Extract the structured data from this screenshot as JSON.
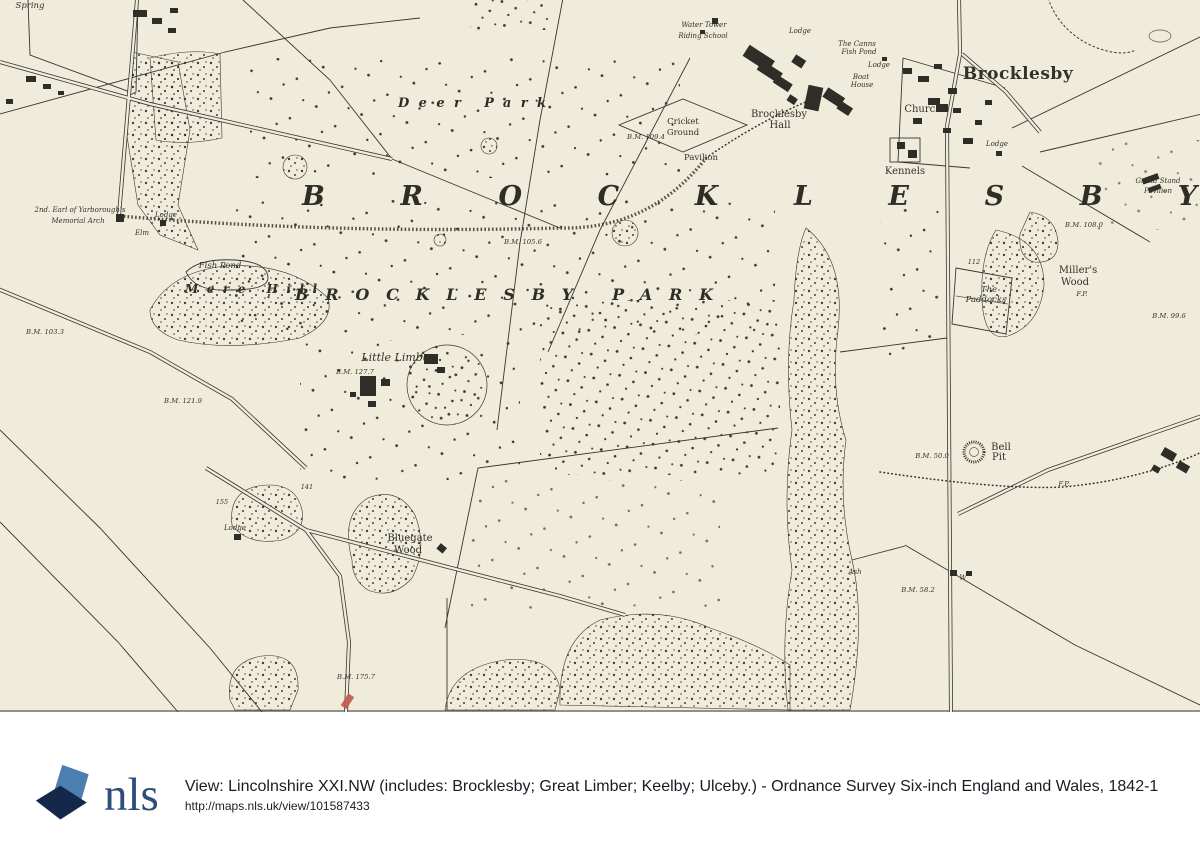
{
  "map": {
    "background_color": "#f0ecdb",
    "ink_color": "#38362e",
    "red_mark_color": "#c4574b",
    "titles": {
      "district": "BROCKLESBY",
      "park": "BROCKLESBY PARK",
      "deer_park": "Deer Park",
      "mere_hill": "Mere Hill"
    },
    "labels": [
      {
        "text": "Spring",
        "x": 30,
        "y": 8,
        "cls": "s"
      },
      {
        "text": "2nd. Earl of Yarborough's",
        "x": 80,
        "y": 212,
        "cls": "xs"
      },
      {
        "text": "Memorial Arch",
        "x": 78,
        "y": 223,
        "cls": "xs"
      },
      {
        "text": "Lodge",
        "x": 166,
        "y": 217,
        "cls": "xs"
      },
      {
        "text": "Elm",
        "x": 142,
        "y": 235,
        "cls": "xs"
      },
      {
        "text": "Fish Pond",
        "x": 220,
        "y": 268,
        "cls": "s"
      },
      {
        "text": "Water Tower",
        "x": 704,
        "y": 27,
        "cls": "xs"
      },
      {
        "text": "Riding School",
        "x": 703,
        "y": 38,
        "cls": "xs"
      },
      {
        "text": "Lodge",
        "x": 800,
        "y": 33,
        "cls": "xs"
      },
      {
        "text": "The Canns",
        "x": 857,
        "y": 46,
        "cls": "xs"
      },
      {
        "text": "Fish Pond",
        "x": 859,
        "y": 54,
        "cls": "xs"
      },
      {
        "text": "Lodge",
        "x": 879,
        "y": 67,
        "cls": "xs"
      },
      {
        "text": "Boat",
        "x": 861,
        "y": 79,
        "cls": "xs"
      },
      {
        "text": "House",
        "x": 862,
        "y": 87,
        "cls": "xs"
      },
      {
        "text": "B.M. 109.4",
        "x": 646,
        "y": 139,
        "cls": "bm"
      },
      {
        "text": "Cricket",
        "x": 683,
        "y": 124,
        "cls": "rs"
      },
      {
        "text": "Ground",
        "x": 683,
        "y": 135,
        "cls": "rs"
      },
      {
        "text": "Pavilion",
        "x": 701,
        "y": 160,
        "cls": "rs"
      },
      {
        "text": "Brocklesby",
        "x": 779,
        "y": 117,
        "cls": "rm"
      },
      {
        "text": "Hall",
        "x": 780,
        "y": 128,
        "cls": "rm"
      },
      {
        "text": "Church",
        "x": 923,
        "y": 112,
        "cls": "rm"
      },
      {
        "text": "Kennels",
        "x": 905,
        "y": 174,
        "cls": "rm"
      },
      {
        "text": "Brocklesby",
        "x": 1018,
        "y": 79,
        "cls": "vil"
      },
      {
        "text": "Lodge",
        "x": 997,
        "y": 146,
        "cls": "xs"
      },
      {
        "text": "Grand Stand",
        "x": 1158,
        "y": 183,
        "cls": "xs"
      },
      {
        "text": "Pavilion",
        "x": 1158,
        "y": 193,
        "cls": "xs"
      },
      {
        "text": "B.M. 108.0",
        "x": 1084,
        "y": 227,
        "cls": "bm"
      },
      {
        "text": "112",
        "x": 974,
        "y": 264,
        "cls": "num"
      },
      {
        "text": "Miller's",
        "x": 1078,
        "y": 273,
        "cls": "rm"
      },
      {
        "text": "Wood",
        "x": 1075,
        "y": 285,
        "cls": "rm"
      },
      {
        "text": "The",
        "x": 989,
        "y": 292,
        "cls": "s"
      },
      {
        "text": "Paddocks",
        "x": 986,
        "y": 302,
        "cls": "s"
      },
      {
        "text": "F.P.",
        "x": 1082,
        "y": 296,
        "cls": "bm"
      },
      {
        "text": "B.M. 99.6",
        "x": 1169,
        "y": 318,
        "cls": "bm"
      },
      {
        "text": "B.M. 105.6",
        "x": 523,
        "y": 244,
        "cls": "bm"
      },
      {
        "text": "Little Limber",
        "x": 398,
        "y": 361,
        "cls": "m"
      },
      {
        "text": "B.M. 127.7",
        "x": 355,
        "y": 374,
        "cls": "bm"
      },
      {
        "text": "B.M. 103.3",
        "x": 45,
        "y": 334,
        "cls": "bm"
      },
      {
        "text": "B.M. 121.9",
        "x": 183,
        "y": 403,
        "cls": "bm"
      },
      {
        "text": "141",
        "x": 307,
        "y": 489,
        "cls": "num"
      },
      {
        "text": "155",
        "x": 222,
        "y": 504,
        "cls": "num"
      },
      {
        "text": "Lodge",
        "x": 235,
        "y": 530,
        "cls": "xs"
      },
      {
        "text": "Bluegate",
        "x": 410,
        "y": 541,
        "cls": "rm"
      },
      {
        "text": "Wood",
        "x": 408,
        "y": 553,
        "cls": "rm"
      },
      {
        "text": "B.M. 50.0",
        "x": 932,
        "y": 458,
        "cls": "bm"
      },
      {
        "text": "Bell",
        "x": 1001,
        "y": 450,
        "cls": "rm"
      },
      {
        "text": "Pit",
        "x": 999,
        "y": 460,
        "cls": "rm"
      },
      {
        "text": "F.P.",
        "x": 1064,
        "y": 486,
        "cls": "bm"
      },
      {
        "text": "B.M. 175.7",
        "x": 356,
        "y": 679,
        "cls": "bm"
      },
      {
        "text": "Ash",
        "x": 855,
        "y": 574,
        "cls": "xs"
      },
      {
        "text": "B.M. 58.2",
        "x": 918,
        "y": 592,
        "cls": "bm"
      },
      {
        "text": "W",
        "x": 963,
        "y": 580,
        "cls": "xs"
      }
    ]
  },
  "footer": {
    "logo_text": "nls",
    "title": "View: Lincolnshire XXI.NW (includes: Brocklesby; Great Limber; Keelby; Ulceby.) - Ordnance Survey Six-inch England and Wales, 1842-1",
    "url": "http://maps.nls.uk/view/101587433",
    "logo_light_color": "#4c7fb0",
    "logo_dark_color": "#16284a",
    "logo_text_color": "#2e4d7b",
    "text_color": "#1b1b26"
  }
}
